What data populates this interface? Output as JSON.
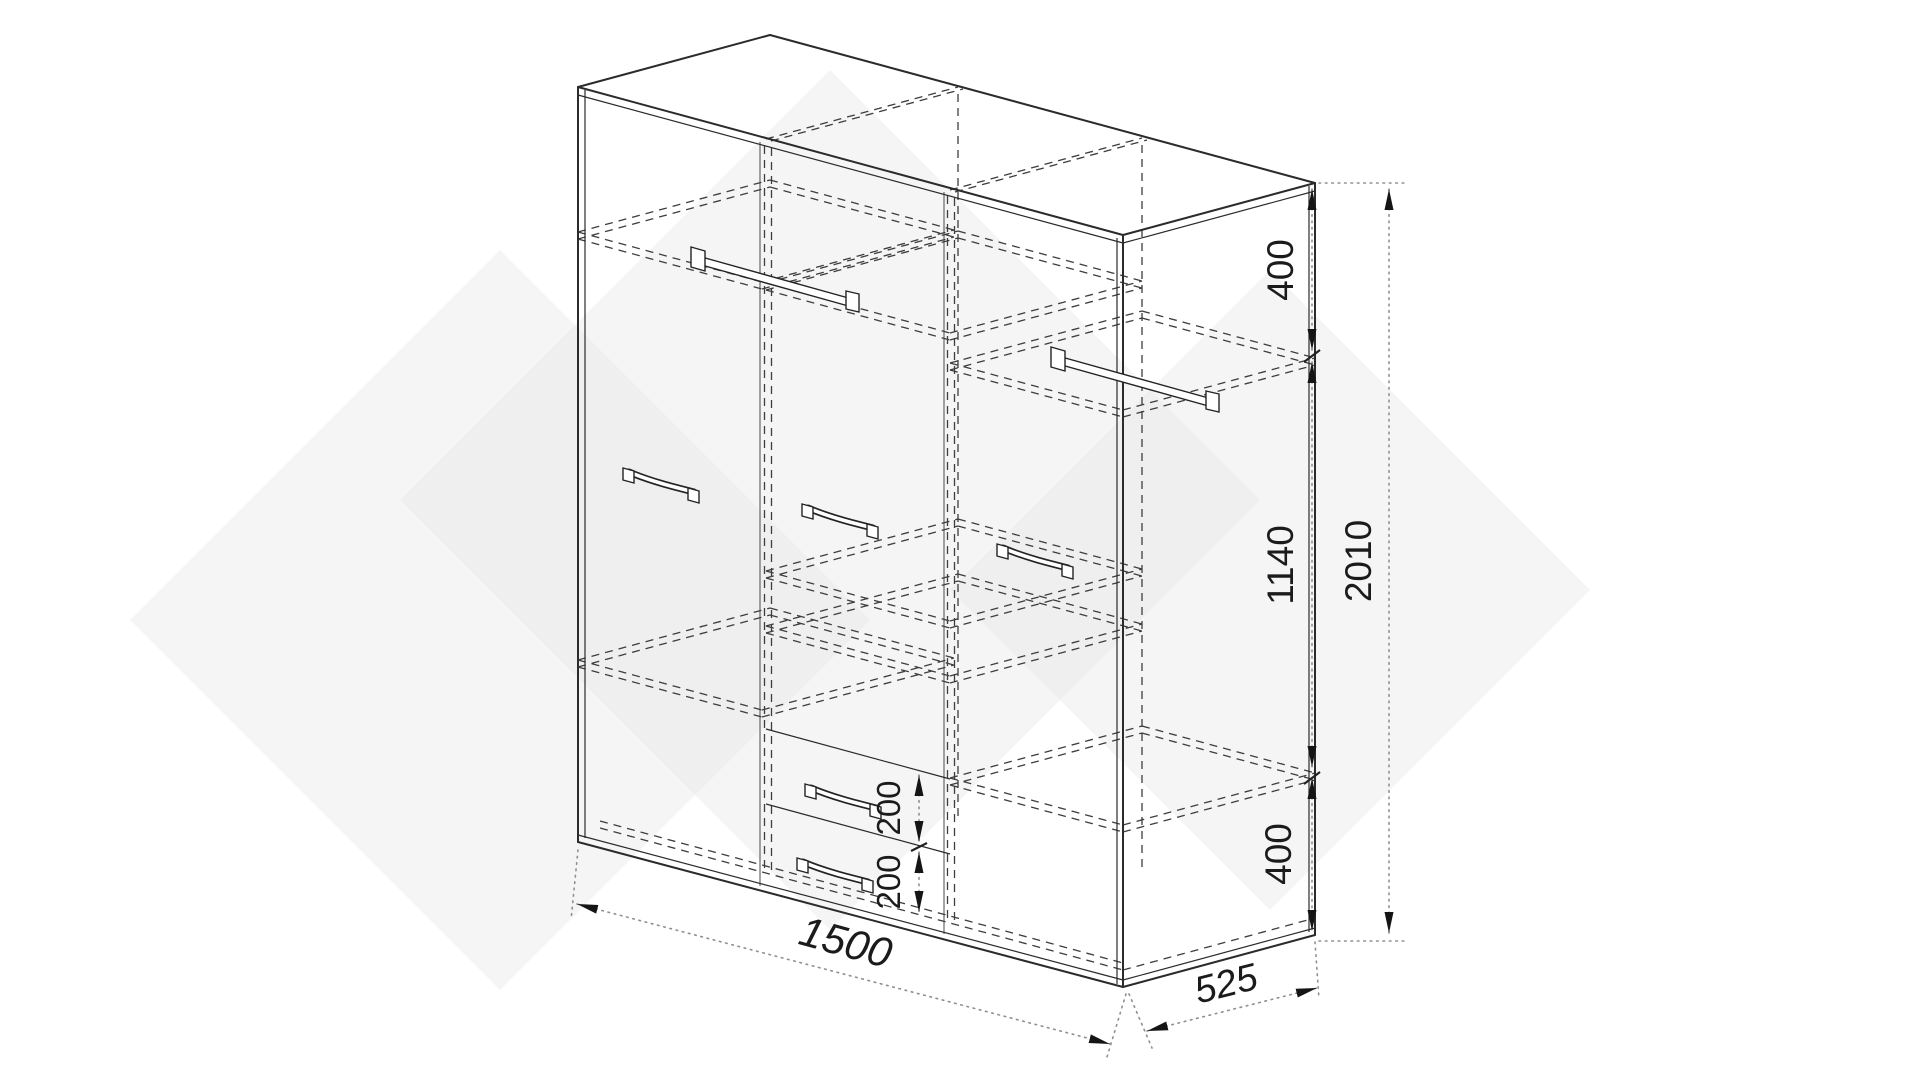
{
  "drawing": {
    "dimensions": {
      "total_height": "2010",
      "upper_section_height": "400",
      "middle_section_height": "1140",
      "lower_section_height": "400",
      "upper_drawer_height": "200",
      "lower_drawer_height": "200",
      "total_width": "1500",
      "total_depth": "525"
    }
  }
}
